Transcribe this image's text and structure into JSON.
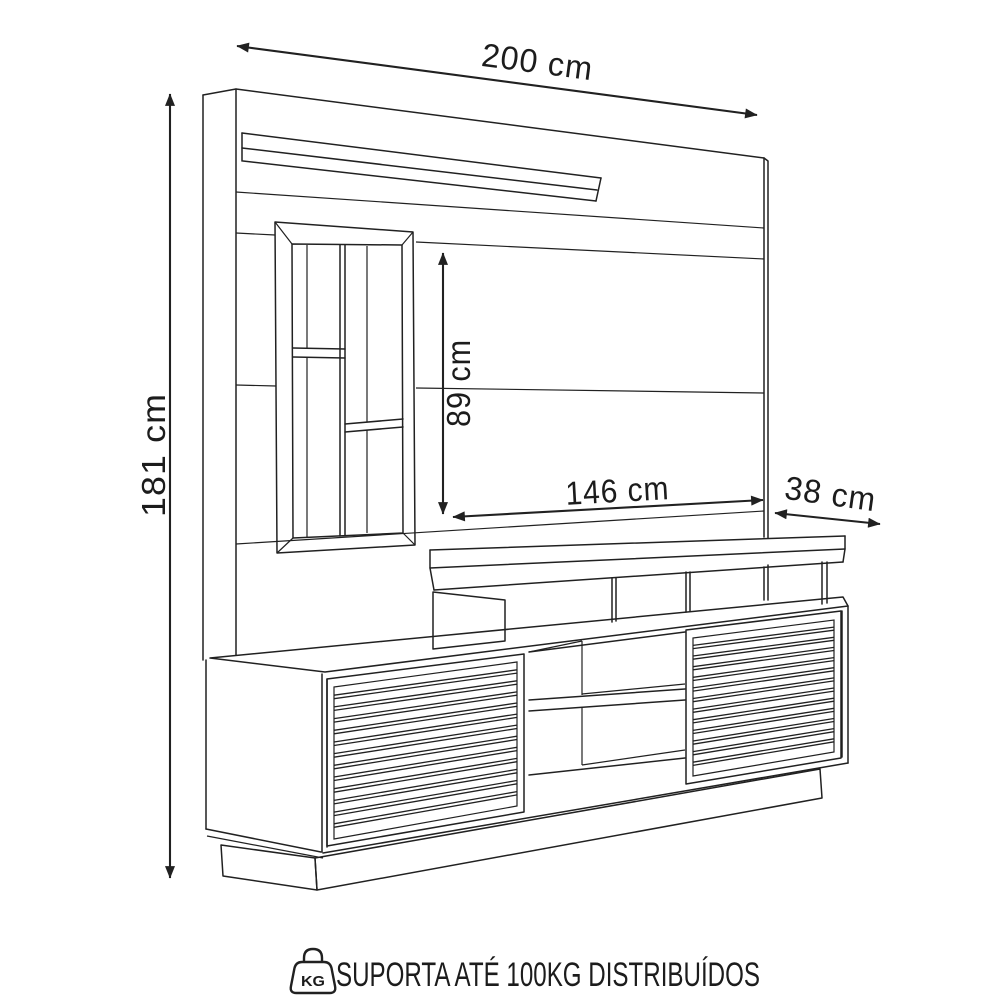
{
  "dimensions": {
    "width": "200 cm",
    "height": "181 cm",
    "tv_space_height": "89 cm",
    "console_width": "146 cm",
    "depth": "38 cm"
  },
  "footer": {
    "kg_badge": "KG",
    "note": "SUPORTA ATÉ 100KG DISTRIBUÍDOS"
  },
  "colors": {
    "line": "#212121",
    "background": "#ffffff"
  }
}
